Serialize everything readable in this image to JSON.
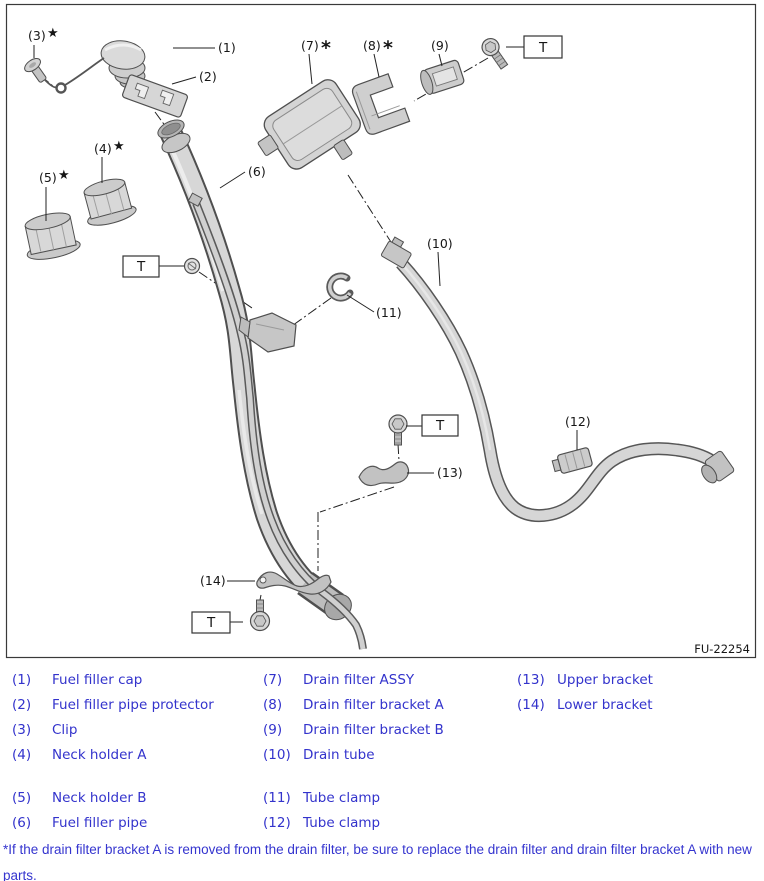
{
  "diagram": {
    "figure_code": "FU-22254",
    "torque_symbol": "T",
    "star_marker": "★",
    "asterisk_marker": "*",
    "callouts": [
      {
        "id": 1,
        "text": "(1)",
        "suffix": ""
      },
      {
        "id": 2,
        "text": "(2)",
        "suffix": ""
      },
      {
        "id": 3,
        "text": "(3)",
        "suffix": "★"
      },
      {
        "id": 4,
        "text": "(4)",
        "suffix": "★"
      },
      {
        "id": 5,
        "text": "(5)",
        "suffix": "★"
      },
      {
        "id": 6,
        "text": "(6)",
        "suffix": ""
      },
      {
        "id": 7,
        "text": "(7)",
        "suffix": "*"
      },
      {
        "id": 8,
        "text": "(8)",
        "suffix": "*"
      },
      {
        "id": 9,
        "text": "(9)",
        "suffix": ""
      },
      {
        "id": 10,
        "text": "(10)",
        "suffix": ""
      },
      {
        "id": 11,
        "text": "(11)",
        "suffix": ""
      },
      {
        "id": 12,
        "text": "(12)",
        "suffix": ""
      },
      {
        "id": 13,
        "text": "(13)",
        "suffix": ""
      },
      {
        "id": 14,
        "text": "(14)",
        "suffix": ""
      }
    ]
  },
  "legend": {
    "columns": [
      {
        "items": [
          {
            "num": "(1)",
            "label": "Fuel filler cap"
          },
          {
            "num": "(2)",
            "label": "Fuel filler pipe protector"
          },
          {
            "num": "(3)",
            "label": "Clip"
          },
          {
            "num": "(4)",
            "label": "Neck holder A"
          },
          {
            "num": "(5)",
            "label": "Neck holder B"
          },
          {
            "num": "(6)",
            "label": "Fuel filler pipe"
          }
        ]
      },
      {
        "items": [
          {
            "num": "(7)",
            "label": "Drain filter ASSY"
          },
          {
            "num": "(8)",
            "label": "Drain filter bracket A"
          },
          {
            "num": "(9)",
            "label": "Drain filter bracket B"
          },
          {
            "num": "(10)",
            "label": "Drain tube"
          },
          {
            "num": "(11)",
            "label": "Tube clamp"
          },
          {
            "num": "(12)",
            "label": "Tube clamp"
          }
        ]
      },
      {
        "items": [
          {
            "num": "(13)",
            "label": "Upper bracket"
          },
          {
            "num": "(14)",
            "label": "Lower bracket"
          }
        ]
      }
    ]
  },
  "footnote": "*If the drain filter bracket A is removed from the drain filter, be sure to replace the drain filter and drain filter bracket A with new parts.",
  "colors": {
    "legend_text": "#3333cc",
    "line_color": "#161616",
    "part_fill": "#d6d6d6"
  }
}
